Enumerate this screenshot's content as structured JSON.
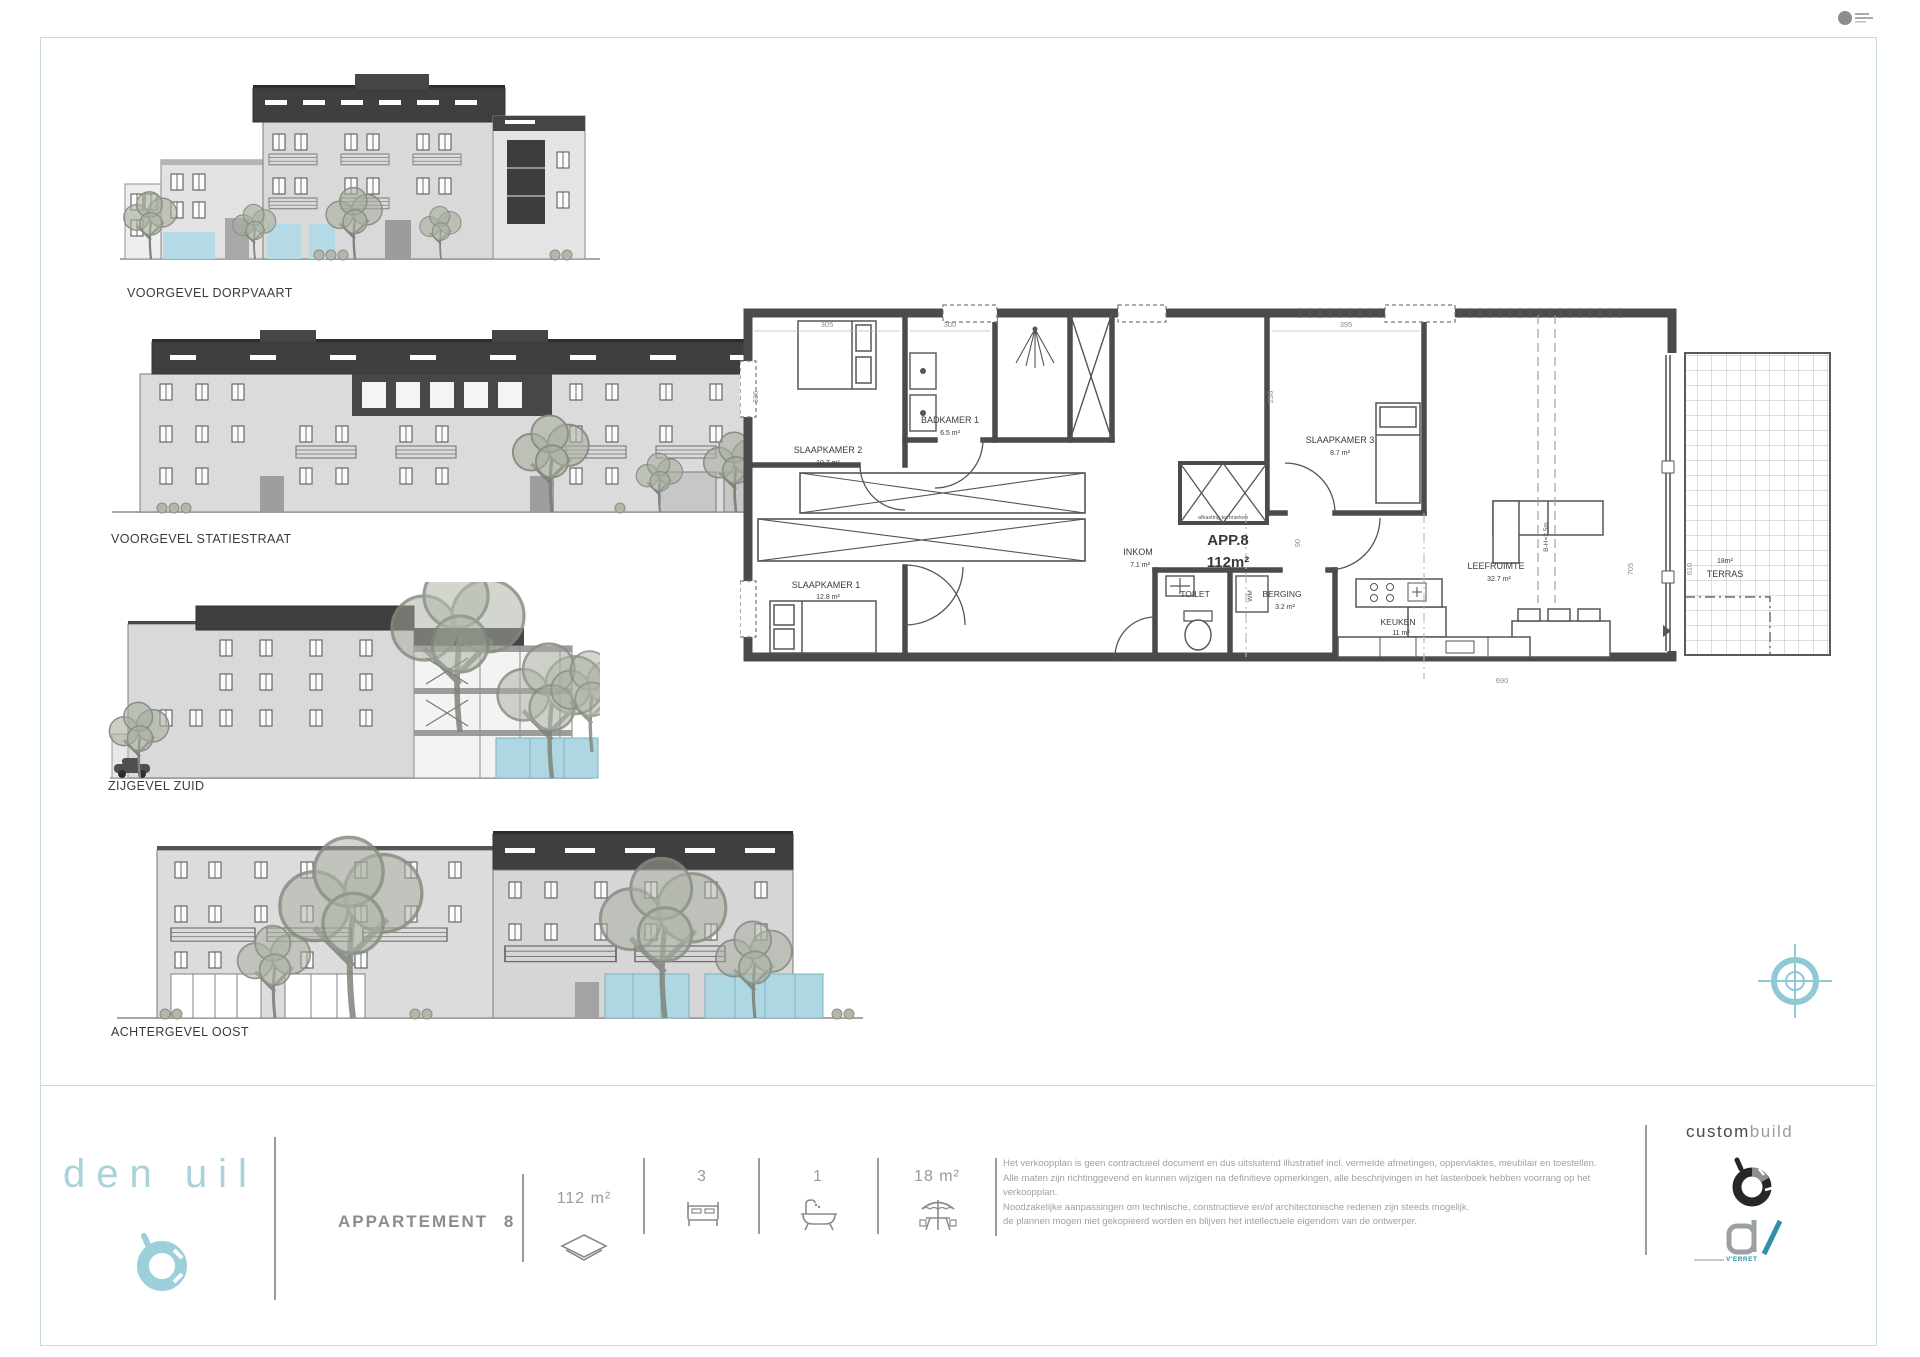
{
  "sheet": {
    "elevations": [
      {
        "label": "VOORGEVEL DORPVAART"
      },
      {
        "label": "VOORGEVEL STATIESTRAAT"
      },
      {
        "label": "ZIJGEVEL ZUID"
      },
      {
        "label": "ACHTERGEVEL OOST"
      }
    ],
    "mark_equals": "="
  },
  "floorplan": {
    "apartment_id": "APP.8",
    "apartment_area": "112m²",
    "rooms": {
      "slaapkamer2": {
        "name": "SLAAPKAMER 2",
        "area": "10.7 m²"
      },
      "badkamer1": {
        "name": "BADKAMER 1",
        "area": "6.5 m²"
      },
      "slaapkamer3": {
        "name": "SLAAPKAMER 3",
        "area": "8.7 m²"
      },
      "slaapkamer1": {
        "name": "SLAAPKAMER 1",
        "area": "12.8 m²"
      },
      "inkom": {
        "name": "INKOM",
        "area": "7.1 m²"
      },
      "toilet": {
        "name": "TOILET"
      },
      "berging": {
        "name": "BERGING",
        "area": "3.2 m²"
      },
      "keuken": {
        "name": "KEUKEN",
        "area": "11 m²"
      },
      "leefruimte": {
        "name": "LEEFRUIMTE",
        "area": "32.7 m²"
      },
      "terras": {
        "name": "TERRAS",
        "area": "18m²"
      }
    },
    "annotations": {
      "tech": "afkasting technieken",
      "wm": "WM",
      "height": "B-H=2.5m"
    },
    "dims": {
      "w_slaapkamer2": "305",
      "w_badkamer": "300",
      "w_slaapkamer3": "395",
      "h_slaapkamer2": "336",
      "h_slaapkamer3": "236",
      "w_door": "90",
      "w_bottom": "690",
      "h_right": "705",
      "h_terras": "610"
    }
  },
  "footer": {
    "brand": "den uil",
    "project_label": "APPARTEMENT 8",
    "stats": [
      {
        "icon": "floor-area",
        "value": "112 m²"
      },
      {
        "icon": "bedrooms",
        "value": "3"
      },
      {
        "icon": "bathrooms",
        "value": "1"
      },
      {
        "icon": "terrace-area",
        "value": "18 m²"
      }
    ],
    "disclaimer": [
      "Het verkoopplan is geen contractueel document en dus uitsluitend illustratief incl. vermelde afmetingen, oppervlaktes, meubilair en toestellen.",
      "Alle maten zijn richtinggevend en kunnen wijzigen na definitieve opmerkingen, alle beschrijvingen in het lastenboek hebben voorrang op het verkoopplan.",
      "Noodzakelijke aanpassingen om technische, constructieve en/of architectonische redenen zijn steeds mogelijk.",
      "de plannen mogen niet gekopieerd worden en blijven het intellectuele eigendom van de ontwerper."
    ],
    "partner": {
      "word1": "custom",
      "word2": "build",
      "subbrand": "V'ERRET"
    }
  }
}
